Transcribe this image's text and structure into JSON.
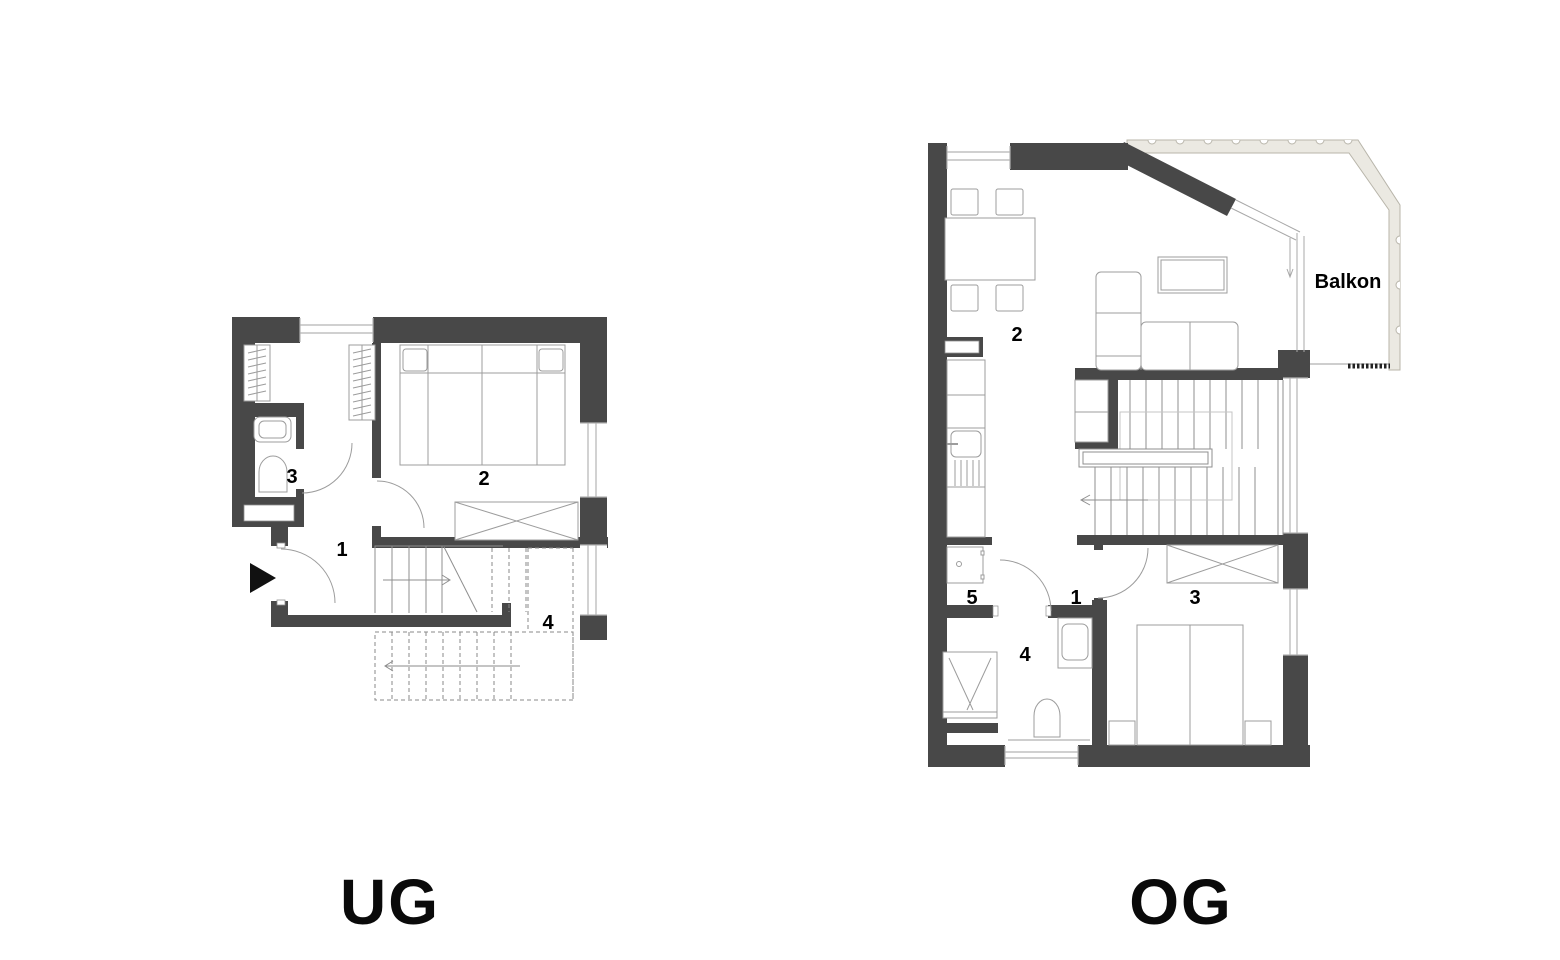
{
  "colors": {
    "wall": "#484848",
    "furniture_line": "#9c9c9c",
    "structure_line": "#8f8f8f",
    "window_line": "#b3b3b3",
    "dashed_line": "#8a8a8a",
    "balcony_fill": "#ebe9e2",
    "balcony_outline": "#b8b5aa",
    "label_color": "#000000"
  },
  "floors": {
    "ug": {
      "label": "UG",
      "rooms": [
        "1",
        "2",
        "3",
        "4"
      ]
    },
    "og": {
      "label": "OG",
      "rooms": [
        "1",
        "2",
        "3",
        "4",
        "5"
      ],
      "balcony_label": "Balkon"
    }
  }
}
